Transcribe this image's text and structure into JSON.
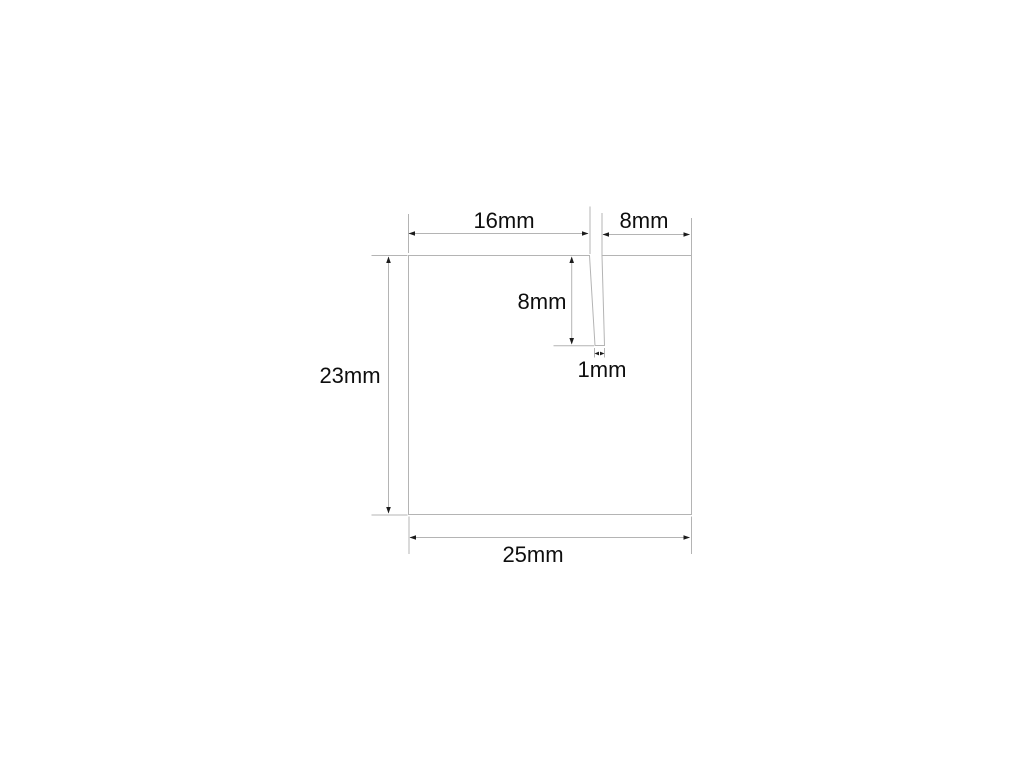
{
  "drawing": {
    "type": "technical-dimension-drawing",
    "unit": "mm",
    "part": {
      "total_width_mm": 25,
      "total_height_mm": 23,
      "slot_offset_left_mm": 16,
      "slot_offset_right_mm": 8,
      "slot_depth_mm": 8,
      "slot_width_mm": 1
    },
    "labels": {
      "top_left_width": "16mm",
      "top_right_width": "8mm",
      "slot_depth": "8mm",
      "slot_width": "1mm",
      "left_height": "23mm",
      "bottom_width": "25mm"
    },
    "colors": {
      "background": "#ffffff",
      "line": "#b4b4b4",
      "arrow": "#1c1c1c",
      "text": "#0e0e0e"
    }
  }
}
